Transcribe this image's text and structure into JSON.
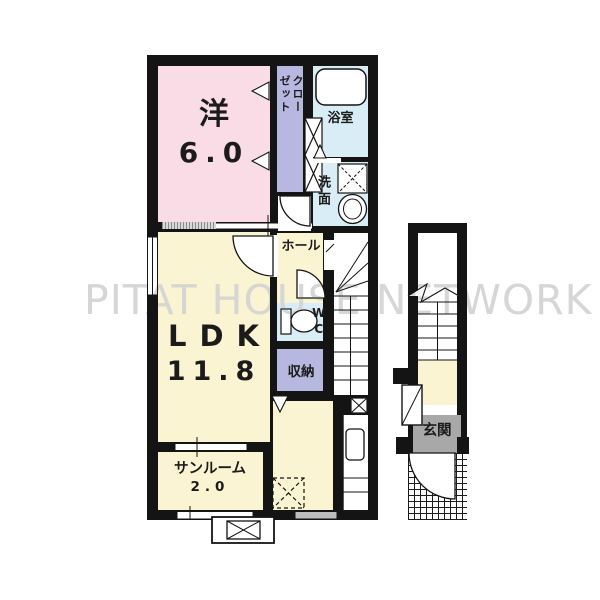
{
  "watermark": "PITAT HOUSE NETWORK",
  "rooms": {
    "western": {
      "label": "洋",
      "size": "6.0"
    },
    "closet": {
      "label": "クローゼット"
    },
    "bath": {
      "label": "浴室"
    },
    "washroom": {
      "label": "洗面"
    },
    "hall": {
      "label": "ホール"
    },
    "wc": {
      "label": "WC"
    },
    "storage": {
      "label": "収納"
    },
    "ldk": {
      "label": "LDK",
      "size": "11.8"
    },
    "sunroom": {
      "label": "サンルーム",
      "size": "2.0"
    },
    "entrance": {
      "label": "玄関"
    }
  },
  "colors": {
    "wall": "#141414",
    "western_pink": "#f9dce6",
    "closet_purple": "#b6b8e0",
    "wet_area_blue": "#d8edf6",
    "living_yellow": "#faf4d2",
    "entrance_gray": "#a8a8a8",
    "watermark_gray": "#d6d6d6"
  }
}
